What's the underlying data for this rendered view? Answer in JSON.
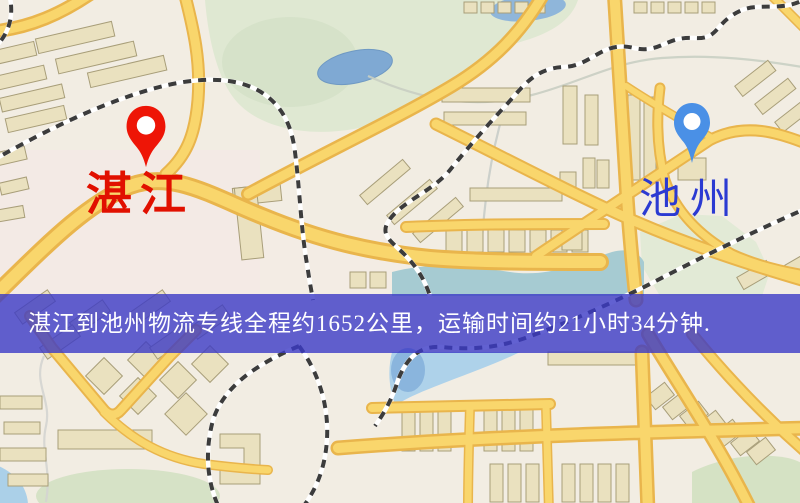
{
  "map": {
    "origin": {
      "name": "湛江",
      "pin_color": "#ee1506",
      "label_color": "#e11000"
    },
    "destination": {
      "name": "池州",
      "pin_color": "#4a90e6",
      "label_color": "#2b3ad2"
    },
    "banner": {
      "text": "湛江到池州物流专线全程约1652公里，运输时间约21小时34分钟.",
      "background_color": "#3b39c5",
      "text_color": "#ffffff",
      "distance_km": "1652",
      "duration": "21小时34分钟"
    },
    "palette": {
      "background": "#f2ede3",
      "road_fill": "#f9d66c",
      "road_casing": "#e9b54c",
      "park_green": "#dfe8d2",
      "water_blue": "#7fa9d3",
      "building": "#eae1bf"
    }
  }
}
